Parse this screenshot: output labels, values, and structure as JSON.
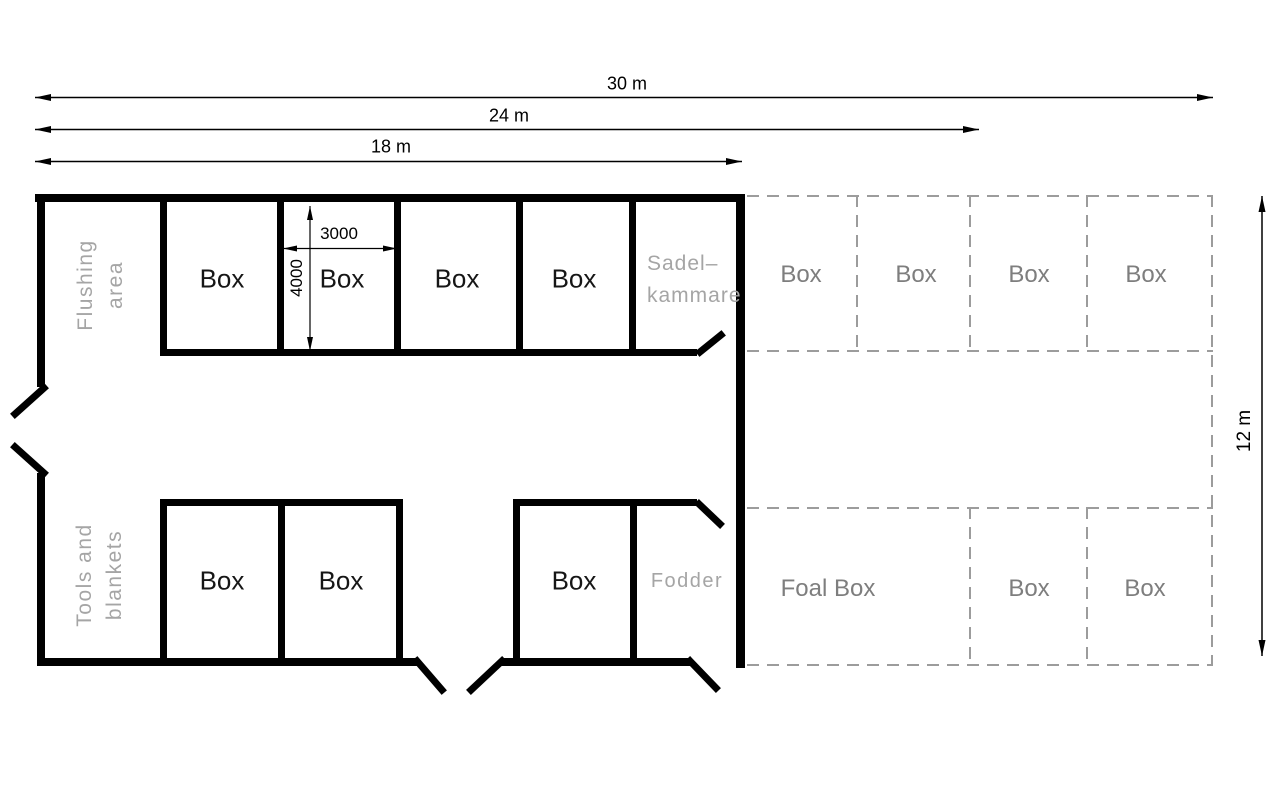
{
  "dimensions": {
    "overall_width": "30 m",
    "width_24": "24 m",
    "width_18": "18 m",
    "height_12": "12 m",
    "box_width_mm": "3000",
    "box_depth_mm": "4000"
  },
  "left_wing": {
    "flushing_area": {
      "line1": "Flushing",
      "line2": "area"
    },
    "tools_blankets": {
      "line1": "Tools and",
      "line2": "blankets"
    },
    "saddle_room": {
      "line1": "Sadel–",
      "line2": "kammare"
    },
    "fodder": "Fodder",
    "top_row_boxes": [
      "Box",
      "Box",
      "Box",
      "Box"
    ],
    "bottom_row_boxes": [
      "Box",
      "Box",
      "Box"
    ]
  },
  "extension_wing": {
    "top_row_boxes": [
      "Box",
      "Box",
      "Box",
      "Box"
    ],
    "foal_box": "Foal Box",
    "bottom_row_boxes": [
      "Box",
      "Box"
    ]
  },
  "colors": {
    "wall": "#000000",
    "dashed_line": "#9c9c9c",
    "cad_text": "#a5a5a5",
    "gray_text": "#7e7e7e",
    "dark_text": "#161616"
  }
}
